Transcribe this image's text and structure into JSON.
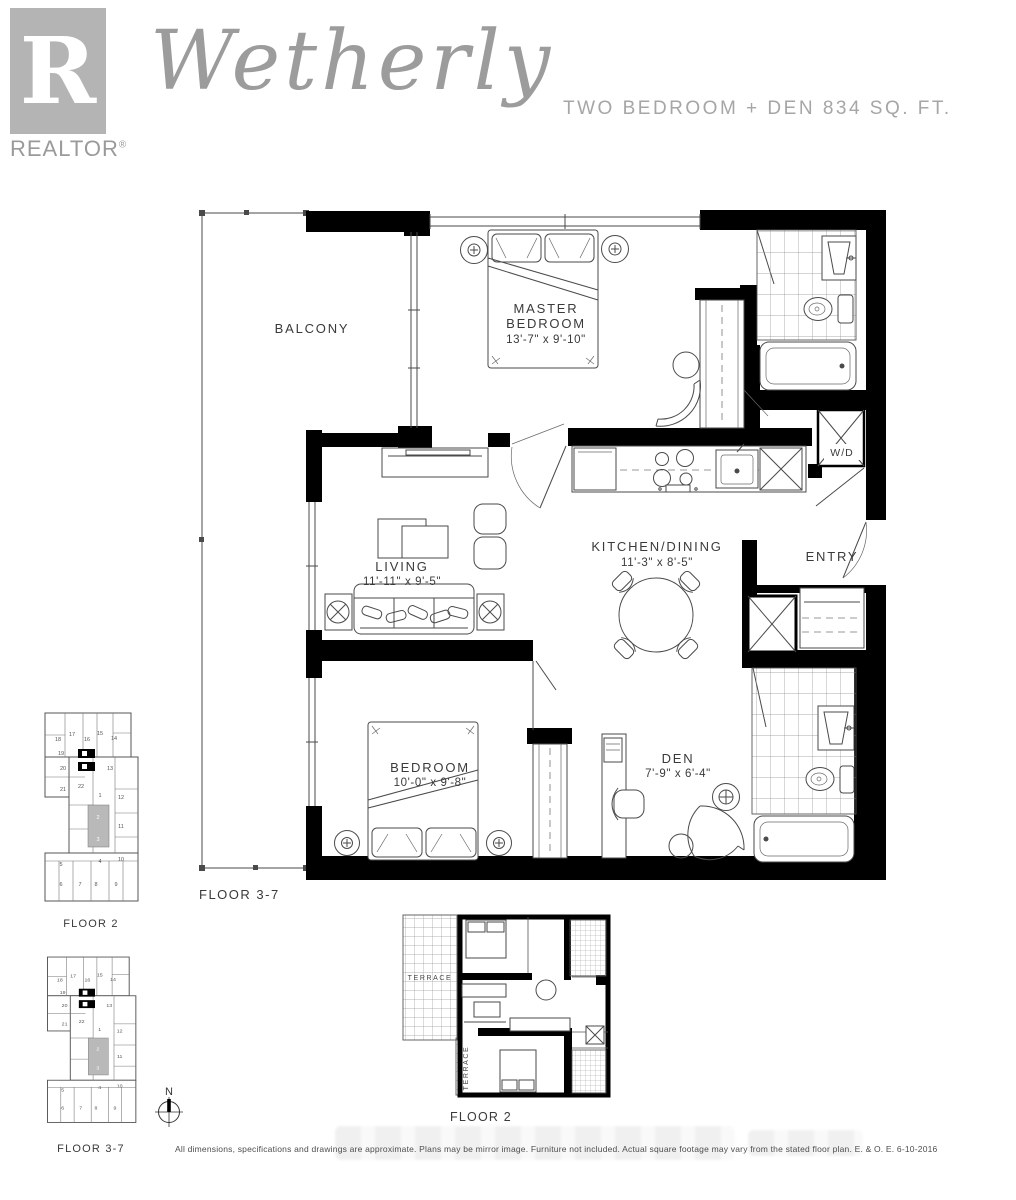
{
  "header": {
    "logo_letter": "R",
    "logo_brand": "REALTOR",
    "logo_reg": "®",
    "title": "Wetherly",
    "subtitle": "TWO BEDROOM + DEN 834 SQ. FT."
  },
  "main_plan": {
    "floor_label": "FLOOR 3-7",
    "balcony": "BALCONY",
    "master_bedroom": {
      "line1": "MASTER",
      "line2": "BEDROOM",
      "dims": "13'-7\" x 9'-10\""
    },
    "living": {
      "name": "LIVING",
      "dims": "11'-11\" x 9'-5\""
    },
    "kitchen": {
      "name": "KITCHEN/DINING",
      "dims": "11'-3\" x 8'-5\""
    },
    "bedroom": {
      "name": "BEDROOM",
      "dims": "10'-0\" x 9'-8\""
    },
    "den": {
      "name": "DEN",
      "dims": "7'-9\" x 6'-4\""
    },
    "entry": "ENTRY",
    "wd": "W/D"
  },
  "key_plans": [
    {
      "label": "FLOOR 2"
    },
    {
      "label": "FLOOR 3-7"
    }
  ],
  "key_plan_highlighted": [
    "2",
    "3"
  ],
  "key_plan_units": [
    {
      "n": "18",
      "x": 23,
      "y": 36
    },
    {
      "n": "17",
      "x": 37,
      "y": 31
    },
    {
      "n": "16",
      "x": 52,
      "y": 36
    },
    {
      "n": "15",
      "x": 65,
      "y": 30
    },
    {
      "n": "14",
      "x": 79,
      "y": 35
    },
    {
      "n": "19",
      "x": 26,
      "y": 50
    },
    {
      "n": "20",
      "x": 28,
      "y": 65
    },
    {
      "n": "21",
      "x": 28,
      "y": 86
    },
    {
      "n": "22",
      "x": 46,
      "y": 83
    },
    {
      "n": "13",
      "x": 75,
      "y": 65
    },
    {
      "n": "1",
      "x": 65,
      "y": 92
    },
    {
      "n": "12",
      "x": 86,
      "y": 94
    },
    {
      "n": "2",
      "x": 63,
      "y": 114
    },
    {
      "n": "11",
      "x": 86,
      "y": 123
    },
    {
      "n": "3",
      "x": 63,
      "y": 136
    },
    {
      "n": "4",
      "x": 65,
      "y": 158
    },
    {
      "n": "10",
      "x": 86,
      "y": 156
    },
    {
      "n": "5",
      "x": 26,
      "y": 161
    },
    {
      "n": "6",
      "x": 26,
      "y": 181
    },
    {
      "n": "7",
      "x": 45,
      "y": 181
    },
    {
      "n": "8",
      "x": 61,
      "y": 181
    },
    {
      "n": "9",
      "x": 81,
      "y": 181
    }
  ],
  "mini_plan": {
    "floor_label": "FLOOR 2",
    "terrace_top": "TERRACE",
    "terrace_side": "TERRACE"
  },
  "compass": {
    "north": "N"
  },
  "disclaimer": "All dimensions, specifications and drawings are approximate. Plans may be mirror image. Furniture not included. Actual square footage may vary from the stated floor plan. E. & O. E. 6-10-2016",
  "colors": {
    "wall": "#000000",
    "line": "#4a4a4a",
    "label": "#3a3a3a",
    "muted_gray": "#9c9c9c",
    "logo_gray": "#b4b4b4",
    "highlight_unit": "#b9b9b9"
  }
}
